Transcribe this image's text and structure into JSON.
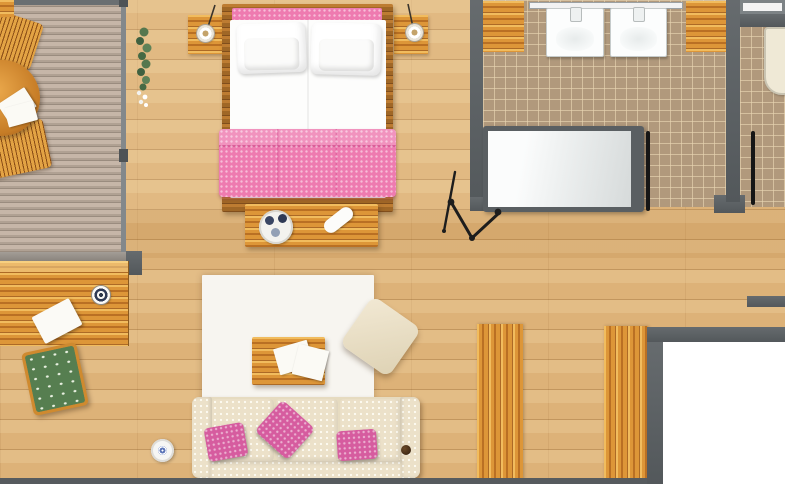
{
  "scene": {
    "title": "Apartment suite floor plan – top-down 3D render",
    "canvas": {
      "width_px": 785,
      "height_px": 484
    }
  },
  "palette": {
    "wood_floor": "#ddb278",
    "wood_floor_seam": "#7c4e1c",
    "deck_wood": "#b5a597",
    "furniture_wood": "#dd9638",
    "furniture_wood_dark": "#8a4d16",
    "wall_gray": "#5b6063",
    "door_black": "#161616",
    "tile_tan": "#b1997c",
    "tile_grout": "#e8d5b2",
    "pink_textile": "#ee7bb0",
    "pink_pillow": "#d65c9f",
    "cream_upholstery": "#ece1c9",
    "rug_white": "#f7f5f0",
    "tub_white": "#f4f6f6",
    "plant_green": "#55774e",
    "stool_green": "#567e50",
    "tray_navy": "#3a4663"
  },
  "rooms": {
    "balcony": "Balcony with wooden deck, round table and two chairs",
    "bedroom": "Sleeping area with double bed",
    "living": "Living area with sofa and white rug",
    "bathroom": "Bathroom with double vanity and bathtub",
    "wc": "Separate WC with toilet",
    "hallway": "Hallway"
  },
  "furniture": {
    "balcony_table": "Round wooden table with open book",
    "balcony_chair_top": "Wooden slatted chair",
    "balcony_chair_bottom": "Wooden slatted chair",
    "open_book": "Open book / menu on table",
    "hanging_plant": "Hanging ivy plant with white blossoms",
    "nightstand_left": "Left nightstand with pendant lamp",
    "nightstand_right": "Right nightstand with pendant lamp",
    "pendant_lamp_left": "Pendant lamp",
    "pendant_lamp_right": "Pendant lamp",
    "double_bed": "Double bed with white linens and pink quilted runner",
    "pillow_left": "White pillow set",
    "pillow_right": "White pillow set",
    "pink_blanket": "Pink quilted runner",
    "foot_bench": "Wooden bench with serving tray and rolled towel",
    "serving_tray": "Round tray with cups",
    "rolled_towel": "Rolled white towel",
    "bathtub": "Bathtub with dark rim and glass screen",
    "bathroom_door": "Open bathroom door",
    "wc_door": "Open WC door",
    "vanity_mirror": "Vanity mirror shelf",
    "sink_left": "Square wash basin",
    "sink_right": "Square wash basin",
    "bath_cabinet_left": "Wooden bath cabinet",
    "bath_cabinet_right": "Wooden bath cabinet",
    "wc_window": "Window",
    "toilet": "Toilet",
    "valet_stand": "Folding valet / luggage stand",
    "rug": "White area rug",
    "coffee_table": "Wooden coffee table with magazines",
    "magazines": "White magazines",
    "pouf": "Cream lounge pouf",
    "sofa": "Cream three-seat sofa with pink cushions",
    "sofa_pillow_1": "Pink cushion",
    "sofa_pillow_2": "Pink cushion",
    "sofa_pillow_3": "Pink cushion",
    "daybed_platform": "Low wooden daybed platform",
    "platform_towel": "White towel",
    "target_cushion": "Round target cushion",
    "green_stool": "Green stool with stag pattern",
    "round_stool": "Round white stool with blue motif",
    "sideboard_1": "Wooden sideboard bench",
    "sideboard_2": "Wooden sideboard bench"
  }
}
